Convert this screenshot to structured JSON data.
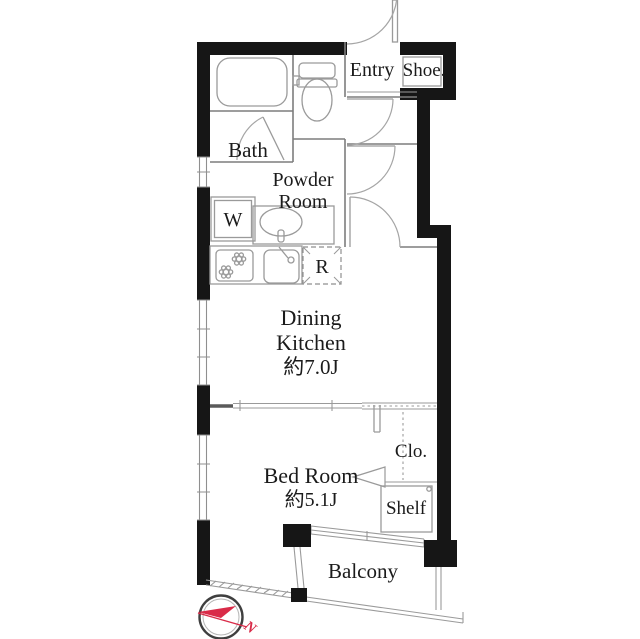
{
  "floorplan": {
    "rooms": {
      "bath": {
        "name": "Bath"
      },
      "powder_room": {
        "name": "Powder Room",
        "line1": "Powder",
        "line2": "Room"
      },
      "entry": {
        "name": "Entry"
      },
      "shoe_box": {
        "name": "Shoe."
      },
      "washing_machine": {
        "name": "W"
      },
      "refrigerator": {
        "name": "R"
      },
      "dining_kitchen": {
        "name": "Dining Kitchen",
        "line1": "Dining",
        "line2": "Kitchen",
        "area": "約7.0J"
      },
      "bed_room": {
        "name": "Bed Room",
        "area": "約5.1J"
      },
      "closet": {
        "name": "Clo."
      },
      "shelf": {
        "name": "Shelf"
      },
      "balcony": {
        "name": "Balcony"
      }
    },
    "compass": {
      "north_label": "N",
      "color": "#d92b48"
    },
    "colors": {
      "wall": "#161616",
      "interior_line": "#7d7d7d",
      "fixture_line": "#9a9a9a",
      "background": "#ffffff"
    }
  }
}
